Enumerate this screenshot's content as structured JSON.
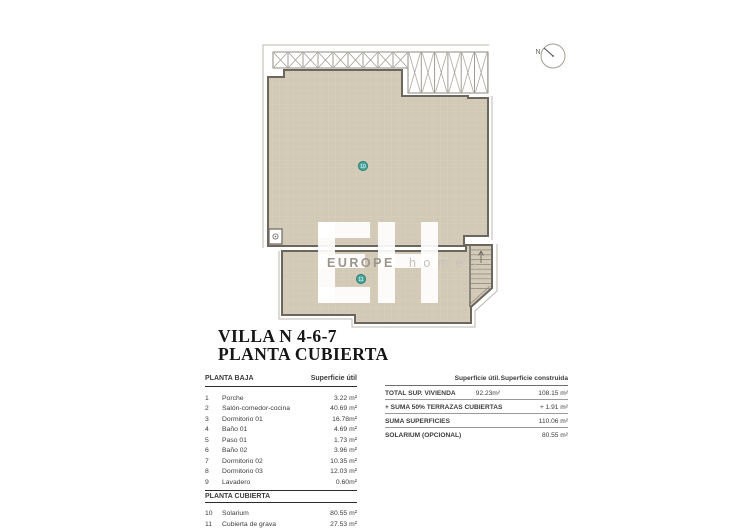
{
  "title": {
    "line1": "VILLA N 4-6-7",
    "line2": "PLANTA CUBIERTA"
  },
  "compass": {
    "label": "N"
  },
  "watermark": {
    "brand_bold": "EUROPE",
    "brand_light": "h o m e s"
  },
  "plan_markers": [
    {
      "num": "10"
    },
    {
      "num": "11"
    }
  ],
  "left_table": {
    "section1_header": "PLANTA BAJA",
    "col_header": "Superficie útil",
    "rows": [
      {
        "num": "1",
        "name": "Porche",
        "value": "3.22 m²"
      },
      {
        "num": "2",
        "name": "Salón-comedor-cocina",
        "value": "40.69 m²"
      },
      {
        "num": "3",
        "name": "Dormitorio 01",
        "value": "16.78m²"
      },
      {
        "num": "4",
        "name": "Baño 01",
        "value": "4.69 m²"
      },
      {
        "num": "5",
        "name": "Paso 01",
        "value": "1.73 m²"
      },
      {
        "num": "6",
        "name": "Baño 02",
        "value": "3.96 m²"
      },
      {
        "num": "7",
        "name": "Dormitorio 02",
        "value": "10.35 m²"
      },
      {
        "num": "8",
        "name": "Dormitorio 03",
        "value": "12.03 m²"
      },
      {
        "num": "9",
        "name": "Lavadero",
        "value": "0.60m²"
      }
    ],
    "section2_header": "PLANTA CUBIERTA",
    "rows2": [
      {
        "num": "10",
        "name": "Solarium",
        "value": "80.55 m²"
      },
      {
        "num": "11",
        "name": "Cubierta de grava",
        "value": "27.53 m²"
      }
    ]
  },
  "right_table": {
    "col1_header": "Superficie útil.",
    "col2_header": "Superficie construida",
    "rows": [
      {
        "label": "TOTAL SUP. VIVIENDA",
        "util": "92.23m²",
        "built": "108.15 m²"
      },
      {
        "label": "+ SUMA 50% TERRAZAS CUBIERTAS",
        "util": "",
        "built": "+ 1.91 m²"
      },
      {
        "label": "SUMA SUPERFICIES",
        "util": "",
        "built": "110.06 m²"
      },
      {
        "label": "SOLARIUM (OPCIONAL)",
        "util": "",
        "built": "80.55 m²"
      }
    ]
  },
  "colors": {
    "roof_tile_fill": "#d3c9b7",
    "wall_line": "#6b665e",
    "light_outline": "#bcb7af",
    "marker_teal": "#4aa9a1",
    "marker_teal_border": "#247a74",
    "watermark_gray": "#9c968c",
    "watermark_light_gray": "#c6c0b6"
  }
}
